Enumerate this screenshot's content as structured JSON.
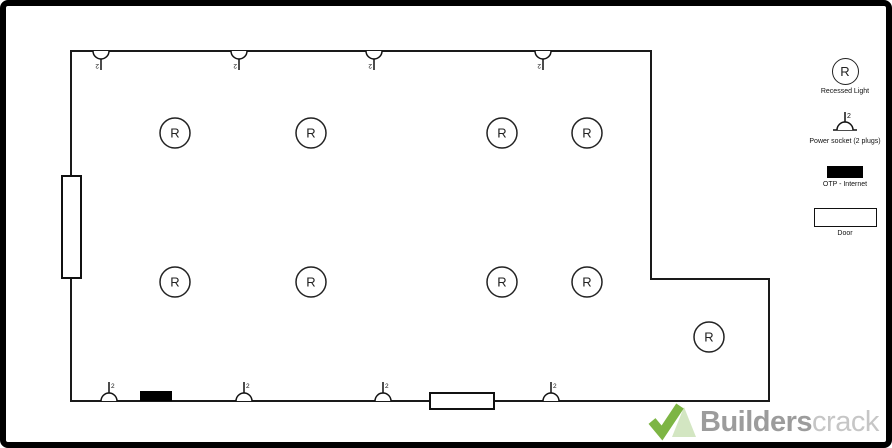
{
  "app": {
    "background": "#ffffff",
    "frame_color": "#000000",
    "wall_color": "#1a1a1a"
  },
  "legend": {
    "items": [
      {
        "id": "recessed-light",
        "symbol": "circle",
        "symbol_text": "R",
        "label": "Recessed Light"
      },
      {
        "id": "power-socket",
        "symbol": "socket",
        "symbol_text": "2",
        "label": "Power socket (2 plugs)"
      },
      {
        "id": "internet",
        "symbol": "filled-rect",
        "label": "OTP - Internet"
      },
      {
        "id": "door",
        "symbol": "outline-rect",
        "label": "Door"
      }
    ]
  },
  "plan": {
    "symbol_text": {
      "light": "R",
      "socket": "2"
    },
    "walls": {
      "points": "65,45 645,45 645,273 763,273 763,395 65,395",
      "color": "#1a1a1a"
    },
    "lights": [
      {
        "x": 169,
        "y": 127
      },
      {
        "x": 305,
        "y": 127
      },
      {
        "x": 496,
        "y": 127
      },
      {
        "x": 581,
        "y": 127
      },
      {
        "x": 169,
        "y": 276
      },
      {
        "x": 305,
        "y": 276
      },
      {
        "x": 496,
        "y": 276
      },
      {
        "x": 581,
        "y": 276
      },
      {
        "x": 703,
        "y": 331
      }
    ],
    "sockets": [
      {
        "x": 95,
        "y": 45,
        "dir": "down"
      },
      {
        "x": 233,
        "y": 45,
        "dir": "down"
      },
      {
        "x": 368,
        "y": 45,
        "dir": "down"
      },
      {
        "x": 537,
        "y": 45,
        "dir": "down"
      },
      {
        "x": 103,
        "y": 395,
        "dir": "up"
      },
      {
        "x": 238,
        "y": 395,
        "dir": "up"
      },
      {
        "x": 377,
        "y": 395,
        "dir": "up"
      },
      {
        "x": 545,
        "y": 395,
        "dir": "up"
      }
    ],
    "internet_points": [
      {
        "x": 134,
        "y": 385,
        "w": 32,
        "h": 10
      }
    ],
    "doors": [
      {
        "x": 56,
        "y": 170,
        "w": 19,
        "h": 102,
        "orientation": "vertical"
      },
      {
        "x": 424,
        "y": 387,
        "w": 64,
        "h": 16,
        "orientation": "horizontal"
      }
    ]
  },
  "watermark": {
    "brand_bold": "Builders",
    "brand_light": "crack",
    "check_color": "#7db544",
    "triangle_color": "#d3e6c2",
    "text_color_bold": "#9c9c9c",
    "text_color_light": "#c6c6c6"
  }
}
